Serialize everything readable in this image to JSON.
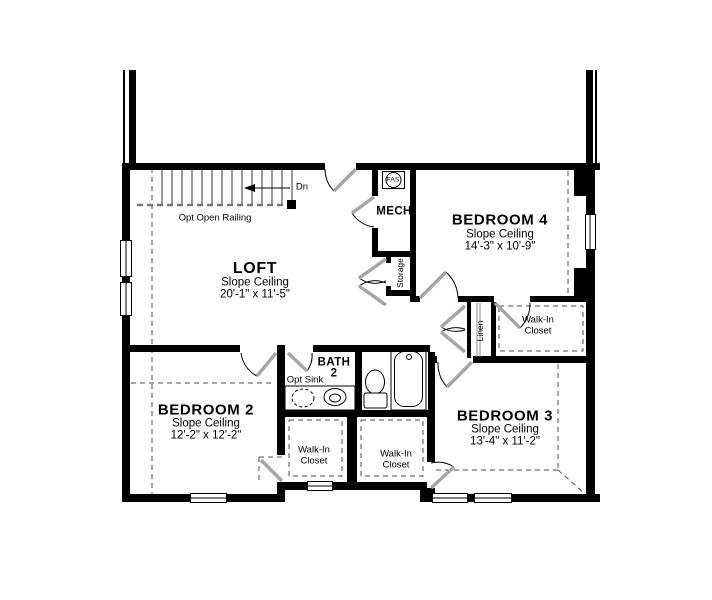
{
  "rooms": {
    "loft": {
      "name": "LOFT",
      "ceiling": "Slope Ceiling",
      "dims": "20'-1\" x 11'-5\""
    },
    "bedroom2": {
      "name": "BEDROOM 2",
      "ceiling": "Slope Ceiling",
      "dims": "12'-2\" x 12'-2\""
    },
    "bedroom3": {
      "name": "BEDROOM 3",
      "ceiling": "Slope Ceiling",
      "dims": "13'-4\" x 11'-2\""
    },
    "bedroom4": {
      "name": "BEDROOM 4",
      "ceiling": "Slope Ceiling",
      "dims": "14'-3\" x 10'-9\""
    },
    "bath2": {
      "name": "BATH",
      "number": "2"
    },
    "mech": {
      "name": "MECH"
    },
    "storage": {
      "name": "Storage"
    },
    "linen": {
      "name": "Linen"
    },
    "walk_in_closet_bedroom2": {
      "label": "Walk-In\nCloset"
    },
    "walk_in_closet_bedroom3": {
      "label": "Walk-In\nCloset"
    },
    "walk_in_closet_bedroom4": {
      "label": "Walk-In\nCloset"
    }
  },
  "annotations": {
    "stair_direction": "Dn",
    "railing": "Opt Open Railing",
    "optional_sink": "Opt Sink",
    "equipment": "FAS"
  },
  "colors": {
    "wall": "#000000",
    "background": "#ffffff",
    "door_leaf": "#a6a6a6",
    "dashed_line": "#4d4d4d"
  }
}
